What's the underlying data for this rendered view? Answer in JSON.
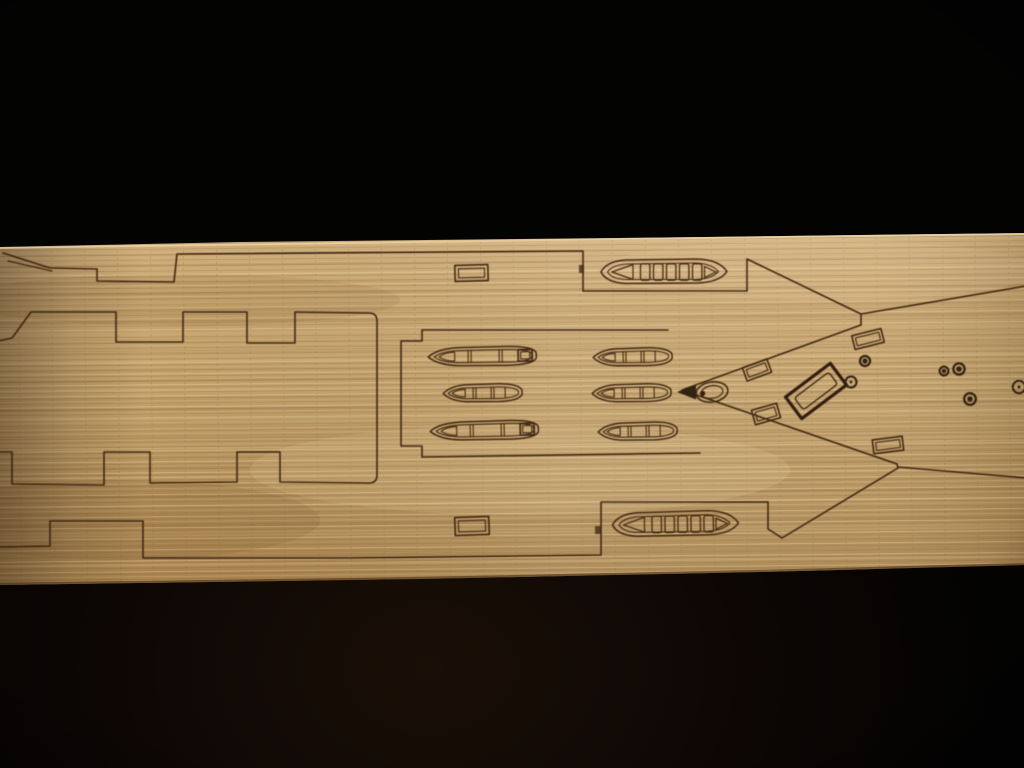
{
  "meta": {
    "alt": "Photograph of a laser-engraved wooden model-ship deck plank lying horizontally on a black background",
    "description": "A long strip of light tan wood veneer crosses the frame against black fabric. Laser-engraved on it is a warship deck plan: stepped battlement-style superstructure outlines on the left, a central deck with six small rowboats in two columns and two slatted ship's boats in recesses, and a pointed bow section on the right with an oval fitting, angled hatches, a large rotated companionway and small round deck fittings."
  },
  "scene": {
    "subject": "laser-cut wooden deck sheet for a ship model",
    "background_color": "#030302",
    "wood": {
      "base": "#bf9c66",
      "light": "#dcc092",
      "dark": "#7a5a33",
      "edge_highlight": "#eed8a8"
    },
    "engraving_color": "#3a240e",
    "inventory": {
      "rowboats": 6,
      "slatted_boats": 2,
      "rect_hatches": 6,
      "companionways": 1,
      "bow_oval_fittings": 1,
      "round_deck_fittings": 6,
      "battlement_notches_top": 3,
      "battlement_notches_bottom": 3
    }
  }
}
